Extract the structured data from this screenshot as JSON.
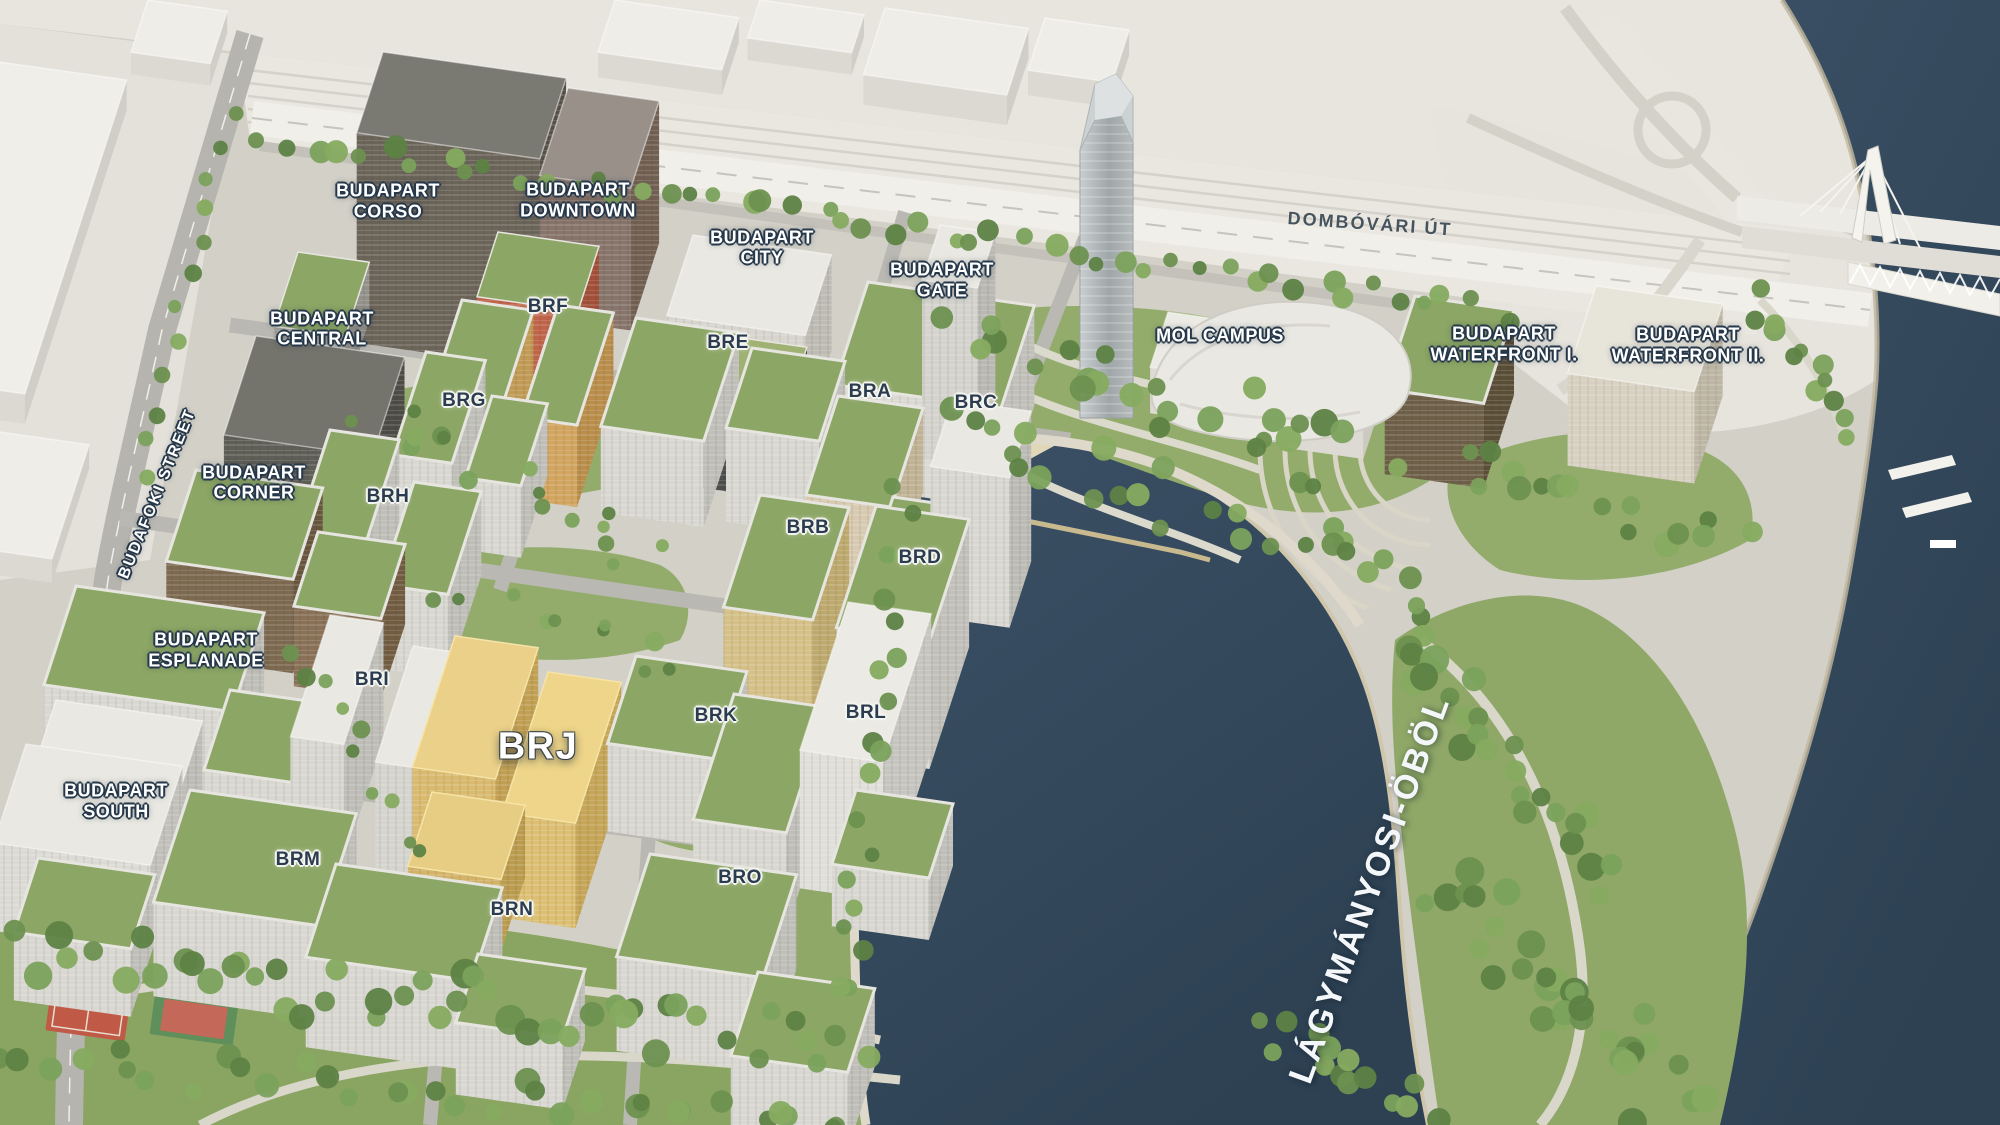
{
  "map": {
    "description": "aerial 3d masterplan render",
    "labels": [
      {
        "id": "budapart-corso",
        "text": "BUDAPART\nCORSO",
        "type": "project",
        "x": 19.4,
        "y": 17.9
      },
      {
        "id": "budapart-downtown",
        "text": "BUDAPART\nDOWNTOWN",
        "type": "project",
        "x": 28.9,
        "y": 17.8
      },
      {
        "id": "budapart-city",
        "text": "BUDAPART\nCITY",
        "type": "project",
        "x": 38.1,
        "y": 22.0
      },
      {
        "id": "budapart-gate",
        "text": "BUDAPART\nGATE",
        "type": "project",
        "x": 47.1,
        "y": 24.9
      },
      {
        "id": "mol-campus",
        "text": "MOL CAMPUS",
        "type": "project",
        "x": 61.0,
        "y": 29.9
      },
      {
        "id": "budapart-waterfront-i",
        "text": "BUDAPART\nWATERFRONT I.",
        "type": "project",
        "x": 75.2,
        "y": 30.6
      },
      {
        "id": "budapart-waterfront-ii",
        "text": "BUDAPART\nWATERFRONT II.",
        "type": "project",
        "x": 84.4,
        "y": 30.7
      },
      {
        "id": "budapart-central",
        "text": "BUDAPART\nCENTRAL",
        "type": "project",
        "x": 16.1,
        "y": 29.2
      },
      {
        "id": "brf",
        "text": "BRF",
        "type": "code",
        "x": 27.4,
        "y": 27.3
      },
      {
        "id": "bre",
        "text": "BRE",
        "type": "code",
        "x": 36.4,
        "y": 30.5
      },
      {
        "id": "bra",
        "text": "BRA",
        "type": "code",
        "x": 43.5,
        "y": 34.8
      },
      {
        "id": "brc",
        "text": "BRC",
        "type": "code",
        "x": 48.8,
        "y": 35.8
      },
      {
        "id": "brg",
        "text": "BRG",
        "type": "code",
        "x": 23.2,
        "y": 35.6
      },
      {
        "id": "budapart-corner",
        "text": "BUDAPART\nCORNER",
        "type": "project",
        "x": 12.7,
        "y": 42.9
      },
      {
        "id": "brh",
        "text": "BRH",
        "type": "code",
        "x": 19.4,
        "y": 44.2
      },
      {
        "id": "brb",
        "text": "BRB",
        "type": "code",
        "x": 40.4,
        "y": 46.9
      },
      {
        "id": "brd",
        "text": "BRD",
        "type": "code",
        "x": 46.0,
        "y": 49.6
      },
      {
        "id": "budapart-esplanade",
        "text": "BUDAPART\nESPLANADE",
        "type": "project",
        "x": 10.3,
        "y": 57.8
      },
      {
        "id": "bri",
        "text": "BRI",
        "type": "code",
        "x": 18.6,
        "y": 60.4
      },
      {
        "id": "brj",
        "text": "BRJ",
        "type": "big",
        "x": 26.9,
        "y": 66.4
      },
      {
        "id": "brk",
        "text": "BRK",
        "type": "code",
        "x": 35.8,
        "y": 63.6
      },
      {
        "id": "brl",
        "text": "BRL",
        "type": "code",
        "x": 43.3,
        "y": 63.4
      },
      {
        "id": "budapart-south",
        "text": "BUDAPART\nSOUTH",
        "type": "project",
        "x": 5.8,
        "y": 71.2
      },
      {
        "id": "brm",
        "text": "BRM",
        "type": "code",
        "x": 14.9,
        "y": 76.4
      },
      {
        "id": "brn",
        "text": "BRN",
        "type": "code",
        "x": 25.6,
        "y": 80.9
      },
      {
        "id": "bro",
        "text": "BRO",
        "type": "code",
        "x": 37.0,
        "y": 78.0
      },
      {
        "id": "dombovari-ut",
        "text": "DOMBÓVÁRI ÚT",
        "type": "street_dark",
        "x": 68.5,
        "y": 19.9,
        "rot": 4
      },
      {
        "id": "budafoki-street",
        "text": "BUDAFOKI STREET",
        "type": "street_light",
        "x": 7.9,
        "y": 43.9,
        "rot": -68
      },
      {
        "id": "lagymanyosi-obol",
        "text": "LÁGYMÁNYOSI-ÖBÖL",
        "type": "water",
        "x": 68.5,
        "y": 79.0,
        "rot": -70
      }
    ],
    "colors": {
      "water": "#33485a",
      "lawn": "#93ac6c",
      "tree": "#5d8245",
      "land": "#d2d0c7",
      "road": "#b6b5af",
      "background_land": "#e7e5de",
      "building_white": "#e9e8e2",
      "green_roof": "#8ca666",
      "highlight_building": "#e8cf86",
      "orange_building": "#bf6349",
      "dark_building": "#5f5e57",
      "sand": "#e0d6b8"
    }
  }
}
